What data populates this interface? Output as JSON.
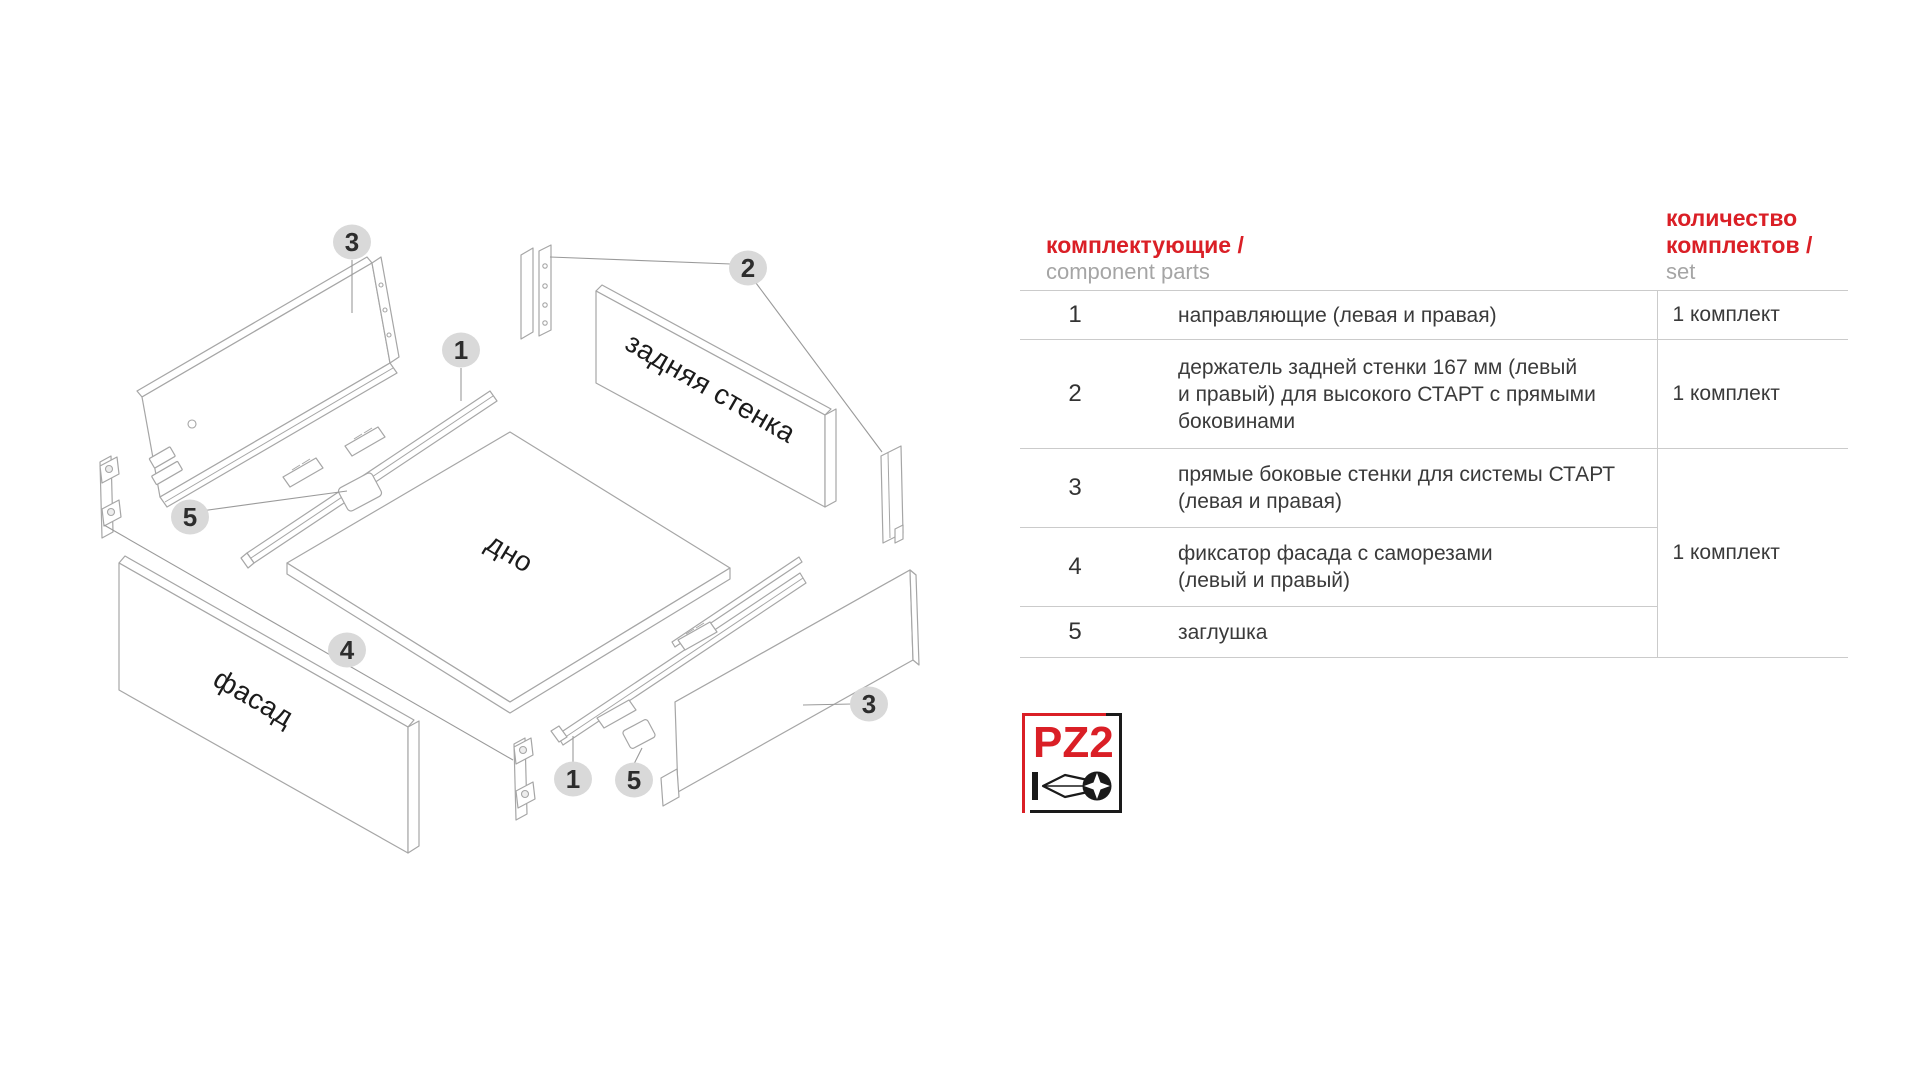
{
  "colors": {
    "red": "#da1f26",
    "gray_en": "#a5a5a5",
    "table_text": "#3a3a3a",
    "table_line": "#cbcbcb",
    "diagram_stroke": "#a6a6a6",
    "callout_bg": "#d9d9d9"
  },
  "diagram": {
    "labels": {
      "back_wall": "задняя стенка",
      "bottom": "дно",
      "facade": "фасад"
    },
    "callouts": [
      {
        "label": "3"
      },
      {
        "label": "1"
      },
      {
        "label": "2"
      },
      {
        "label": "5"
      },
      {
        "label": "4"
      },
      {
        "label": "1"
      },
      {
        "label": "5"
      },
      {
        "label": "3"
      }
    ]
  },
  "table": {
    "header": {
      "parts_ru": "комплектующие /",
      "parts_en": "component parts",
      "qty_ru_line1": "количество",
      "qty_ru_line2": "комплектов /",
      "qty_en": "set"
    },
    "rows": [
      {
        "num": "1",
        "desc_lines": [
          "направляющие (левая и правая)"
        ],
        "qty": "1 комплект"
      },
      {
        "num": "2",
        "desc_lines": [
          "держатель задней стенки 167 мм (левый",
          "и правый) для высокого СТАРТ с прямыми",
          "боковинами"
        ],
        "qty": "1 комплект"
      },
      {
        "num": "3",
        "desc_lines": [
          "прямые боковые стенки для системы СТАРТ",
          "(левая и правая)"
        ]
      },
      {
        "num": "4",
        "desc_lines": [
          "фиксатор фасада с саморезами",
          "(левый и правый)"
        ]
      },
      {
        "num": "5",
        "desc_lines": [
          "заглушка"
        ]
      }
    ],
    "merged_qty": "1 комплект"
  },
  "logo": {
    "label": "PZ2"
  }
}
